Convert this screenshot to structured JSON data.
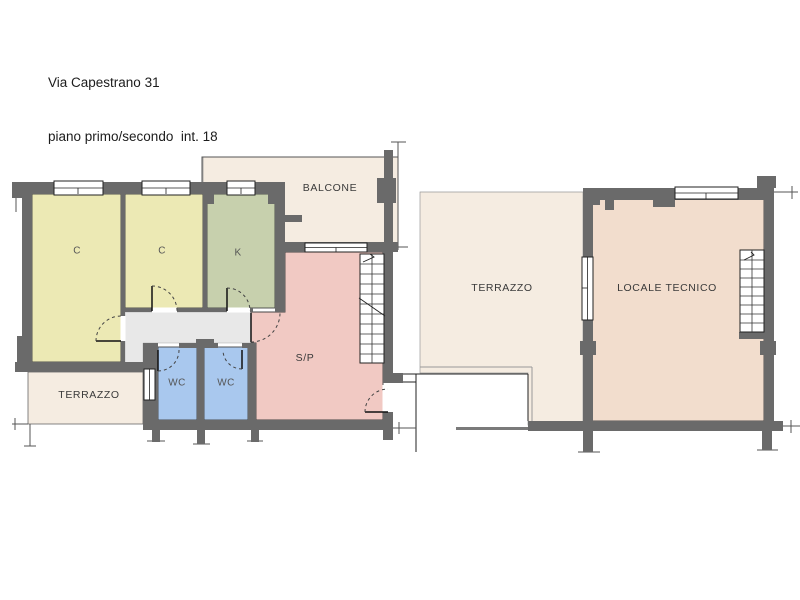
{
  "title": {
    "line1": "Via Capestrano 31",
    "line2": "piano primo/secondo  int. 18"
  },
  "rooms": {
    "c1": "C",
    "c2": "C",
    "k": "K",
    "balcone": "BALCONE",
    "sp": "S/P",
    "wc1": "WC",
    "wc2": "WC",
    "terrazzo_left": "TERRAZZO",
    "terrazzo_right": "TERRAZZO",
    "locale_tecnico": "LOCALE TECNICO"
  },
  "colors": {
    "wall_gray": "#6a6a6a",
    "bedroom_yellow": "#ece9b4",
    "kitchen_green": "#c7d0ad",
    "wc_blue": "#a9c8ee",
    "living_pink": "#f1c9c3",
    "tech_salmon": "#f2ddcd",
    "outdoor_beige": "#f5ece1",
    "corridor_gray": "#e8e8e8"
  }
}
